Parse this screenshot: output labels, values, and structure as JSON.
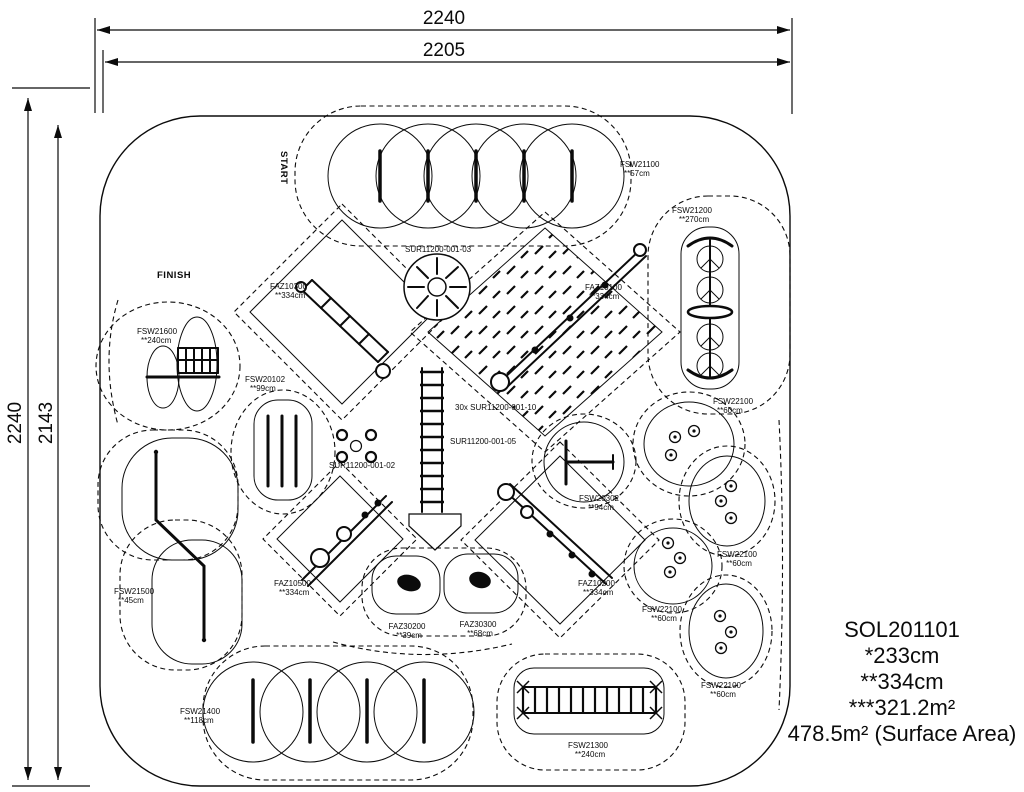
{
  "drawing_title": "SOL201101 playground layout plan",
  "dimensions": {
    "top_outer": "2240",
    "top_inner": "2205",
    "left_outer": "2240",
    "left_inner": "2143"
  },
  "markers": {
    "start": "START",
    "finish": "FINISH"
  },
  "legend": {
    "code": "SOL201101",
    "height1": "*233cm",
    "height2": "**334cm",
    "area1": "***321.2m²",
    "area2": "478.5m² (Surface Area)"
  },
  "labels": [
    {
      "id": "fsw21100",
      "code": "FSW21100",
      "value": "**57cm"
    },
    {
      "id": "fsw21200",
      "code": "FSW21200",
      "value": "**270cm"
    },
    {
      "id": "faz10300",
      "code": "FAZ10300",
      "value": "**334cm"
    },
    {
      "id": "faz10100",
      "code": "FAZ10100",
      "value": "**334cm"
    },
    {
      "id": "fsw21600",
      "code": "FSW21600",
      "value": "**240cm"
    },
    {
      "id": "fsw20102",
      "code": "FSW20102",
      "value": "**99cm"
    },
    {
      "id": "sur-03",
      "code": "SUR11200-001-03",
      "value": ""
    },
    {
      "id": "sur-10",
      "code": "30x SUR11200-001-10",
      "value": ""
    },
    {
      "id": "sur-05",
      "code": "SUR11200-001-05",
      "value": ""
    },
    {
      "id": "sur-02",
      "code": "SUR11200-001-02",
      "value": ""
    },
    {
      "id": "fsw20302",
      "code": "FSW20302",
      "value": "**94cm"
    },
    {
      "id": "fsw21500",
      "code": "FSW21500",
      "value": "**45cm"
    },
    {
      "id": "faz10500",
      "code": "FAZ10500",
      "value": "**334cm"
    },
    {
      "id": "faz30200",
      "code": "FAZ30200",
      "value": "**39cm"
    },
    {
      "id": "faz30300",
      "code": "FAZ30300",
      "value": "**68cm"
    },
    {
      "id": "faz10200",
      "code": "FAZ10200",
      "value": "**334cm"
    },
    {
      "id": "fsw22100-a",
      "code": "FSW22100",
      "value": "**60cm"
    },
    {
      "id": "fsw22100-b",
      "code": "FSW22100",
      "value": "**60cm"
    },
    {
      "id": "fsw22100-c",
      "code": "FSW22100",
      "value": "**60cm"
    },
    {
      "id": "fsw22100-d",
      "code": "FSW22100",
      "value": "**60cm"
    },
    {
      "id": "fsw21400",
      "code": "FSW21400",
      "value": "**118cm"
    },
    {
      "id": "fsw21300",
      "code": "FSW21300",
      "value": "**240cm"
    }
  ]
}
